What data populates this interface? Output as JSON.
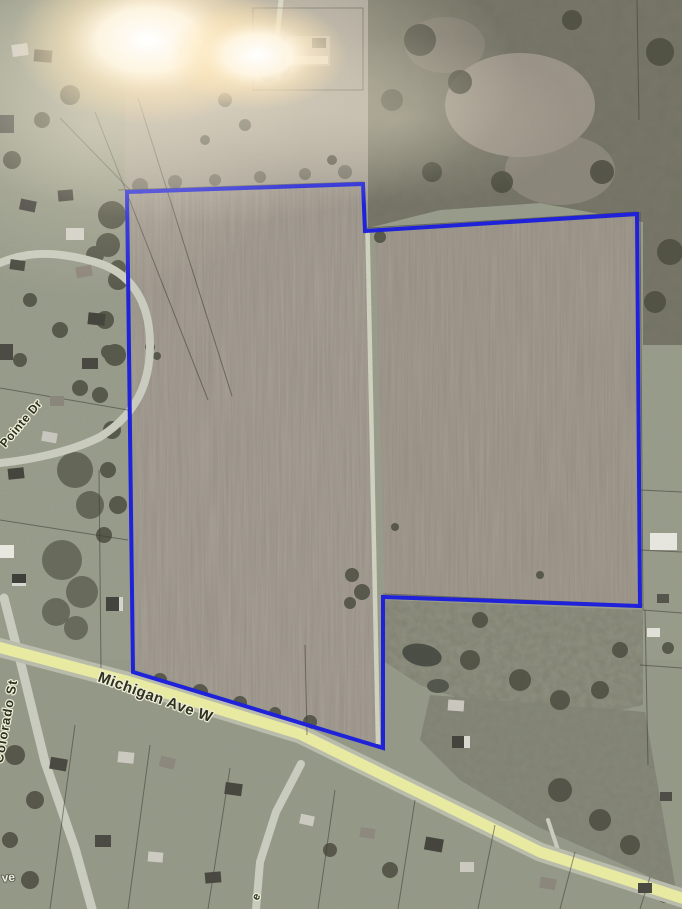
{
  "meta": {
    "view_type": "aerial-satellite-photo",
    "subject": "parcel-boundary-map"
  },
  "labels": {
    "road_main": "Michigan Ave W",
    "road_left": "Colorado St",
    "road_upper_left": "Pointe Dr",
    "road_bottom_left_partial": "ve",
    "road_bottom_center_partial": "e"
  },
  "colors": {
    "boundary": "#1f22d8",
    "road_fill": "#e9eaa2",
    "road_casing": "#b9bcab",
    "field_left": "#aca49a",
    "field_right": "#a89f93",
    "lane": "#d7d9c6",
    "woods_base": "#6c6b5d",
    "grass": "#9a9e8c",
    "label_dark": "#2e2f20",
    "label_halo": "#eef0d8",
    "glare": "#ffffff"
  }
}
